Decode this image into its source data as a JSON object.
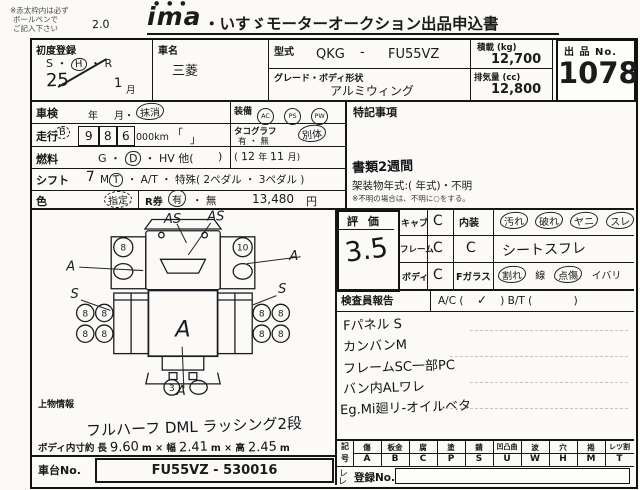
{
  "header": {
    "note1": "※赤太枠内は必ず",
    "note2": "ボールペンで",
    "note3": "ご記入下さい",
    "hand_note": "2.0",
    "logo_dots": "● ● ●",
    "logo": "ima",
    "title": "・いすゞモーターオークション出品申込書"
  },
  "reg": {
    "label": "初度登録",
    "era_s": "S ・",
    "era_h": "H",
    "era_r": "・ R",
    "year": "25",
    "month": "1",
    "month_label": "月"
  },
  "car": {
    "label": "車名",
    "value": "三菱"
  },
  "model": {
    "label": "型式",
    "v1": "QKG",
    "dash": "-",
    "v2": "FU55VZ"
  },
  "grade": {
    "label": "グレード・ボディ形状",
    "value": "アルミウィング"
  },
  "payload": {
    "label": "積載 (kg)",
    "value": "12,700"
  },
  "disp": {
    "label": "排気量 (cc)",
    "value": "12,800"
  },
  "lot": {
    "label": "出 品 No.",
    "value": "1078"
  },
  "shaken": {
    "label": "車検",
    "year": "年",
    "month": "月・",
    "erased": "抹消"
  },
  "mileage": {
    "label": "走行",
    "code": "B",
    "d1": "9",
    "d2": "8",
    "d3": "6",
    "unit": "000km",
    "bl": "「",
    "br": "」"
  },
  "fuel": {
    "label": "燃料",
    "g": "G ・",
    "d": "D",
    "rest": "・ HV 他(",
    "close": ")"
  },
  "shift": {
    "label": "シフト",
    "num": "7",
    "m": "M",
    "t": "T",
    "rest": "・ A/T ・ 特殊( 2ペダル ・ 3ペダル )"
  },
  "color": {
    "label": "色",
    "value": "指定"
  },
  "rticket": {
    "label": "R券",
    "yes": "有",
    "no": "・ 無",
    "price": "13,480",
    "yen": "円"
  },
  "equip": {
    "label": "装備",
    "i1": "AC",
    "i2": "PS",
    "i3": "PW"
  },
  "tacho": {
    "label": "タコグラフ",
    "opts": "有 ・ 無",
    "hand": "別体",
    "open": "(",
    "y": "12",
    "ylabel": "年",
    "m": "11",
    "mlabel": "月)"
  },
  "tokki": {
    "label": "特記事項",
    "docs": "書類2週間",
    "frame": "架装物年式:(          年式)・不明",
    "note": "※不明の場合は、不明に○をする。"
  },
  "diagram": {
    "as1": "AS",
    "as2": "AS",
    "a_left": "A",
    "a_right": "A",
    "s_left": "S",
    "s_right": "S",
    "a_center": "A",
    "a_bottom": "A",
    "fl": "8",
    "fr": "10",
    "rl1": "8",
    "rl2": "8",
    "rl3": "8",
    "rl4": "8",
    "rr1": "8",
    "rr2": "8",
    "rr3": "8",
    "rr4": "8",
    "spare": "3"
  },
  "uwamono": {
    "label": "上物情報",
    "hand": "フルハーフ DML ラッシング2段"
  },
  "dims": {
    "label": "ボディ内寸約",
    "l1": "長",
    "v1": "9.60",
    "l2": "m × 幅",
    "v2": "2.41",
    "l3": "m × 高",
    "v3": "2.45",
    "l4": "m"
  },
  "chassis": {
    "label": "車台No.",
    "value": "FU55VZ - 530016"
  },
  "hyoka": {
    "label": "評 価",
    "score": "3.5",
    "cab": "キャブ",
    "cab_g": "C",
    "frame": "フレーム",
    "frame_g": "C",
    "body": "ボディ",
    "body_g": "C",
    "naiso": "内装",
    "n1": "汚れ",
    "n2": "破れ",
    "n3": "ヤニ",
    "n4": "スレ",
    "naiso_g": "C",
    "naiso_hand": "シートスフレ",
    "fglass": "Fガラス",
    "f1": "割れ",
    "f2": "線",
    "f3": "点傷",
    "f4": "イバリ"
  },
  "inspector": {
    "label": "検査員報告",
    "ac": "A/C (",
    "check": "✓",
    "mid": ")   B/T (",
    "end": ")",
    "lines": [
      "Fパネル S",
      "カンバンM",
      "フレームSC一部PC",
      "バン内ALワレ",
      "Eg.Mi廻リ-オイルベタ"
    ]
  },
  "legend": {
    "rl1": "記",
    "rl2": "号",
    "cols": [
      [
        "傷",
        "A"
      ],
      [
        "板金",
        "B"
      ],
      [
        "腐",
        "C"
      ],
      [
        "塗",
        "P"
      ],
      [
        "錆",
        "S"
      ],
      [
        "凹凸曲",
        "U"
      ],
      [
        "波",
        "W"
      ],
      [
        "穴",
        "H"
      ],
      [
        "捲",
        "M"
      ],
      [
        "レツ割",
        "T"
      ]
    ],
    "check1": "レ",
    "check2": "レ",
    "reg_label": "登録No."
  }
}
